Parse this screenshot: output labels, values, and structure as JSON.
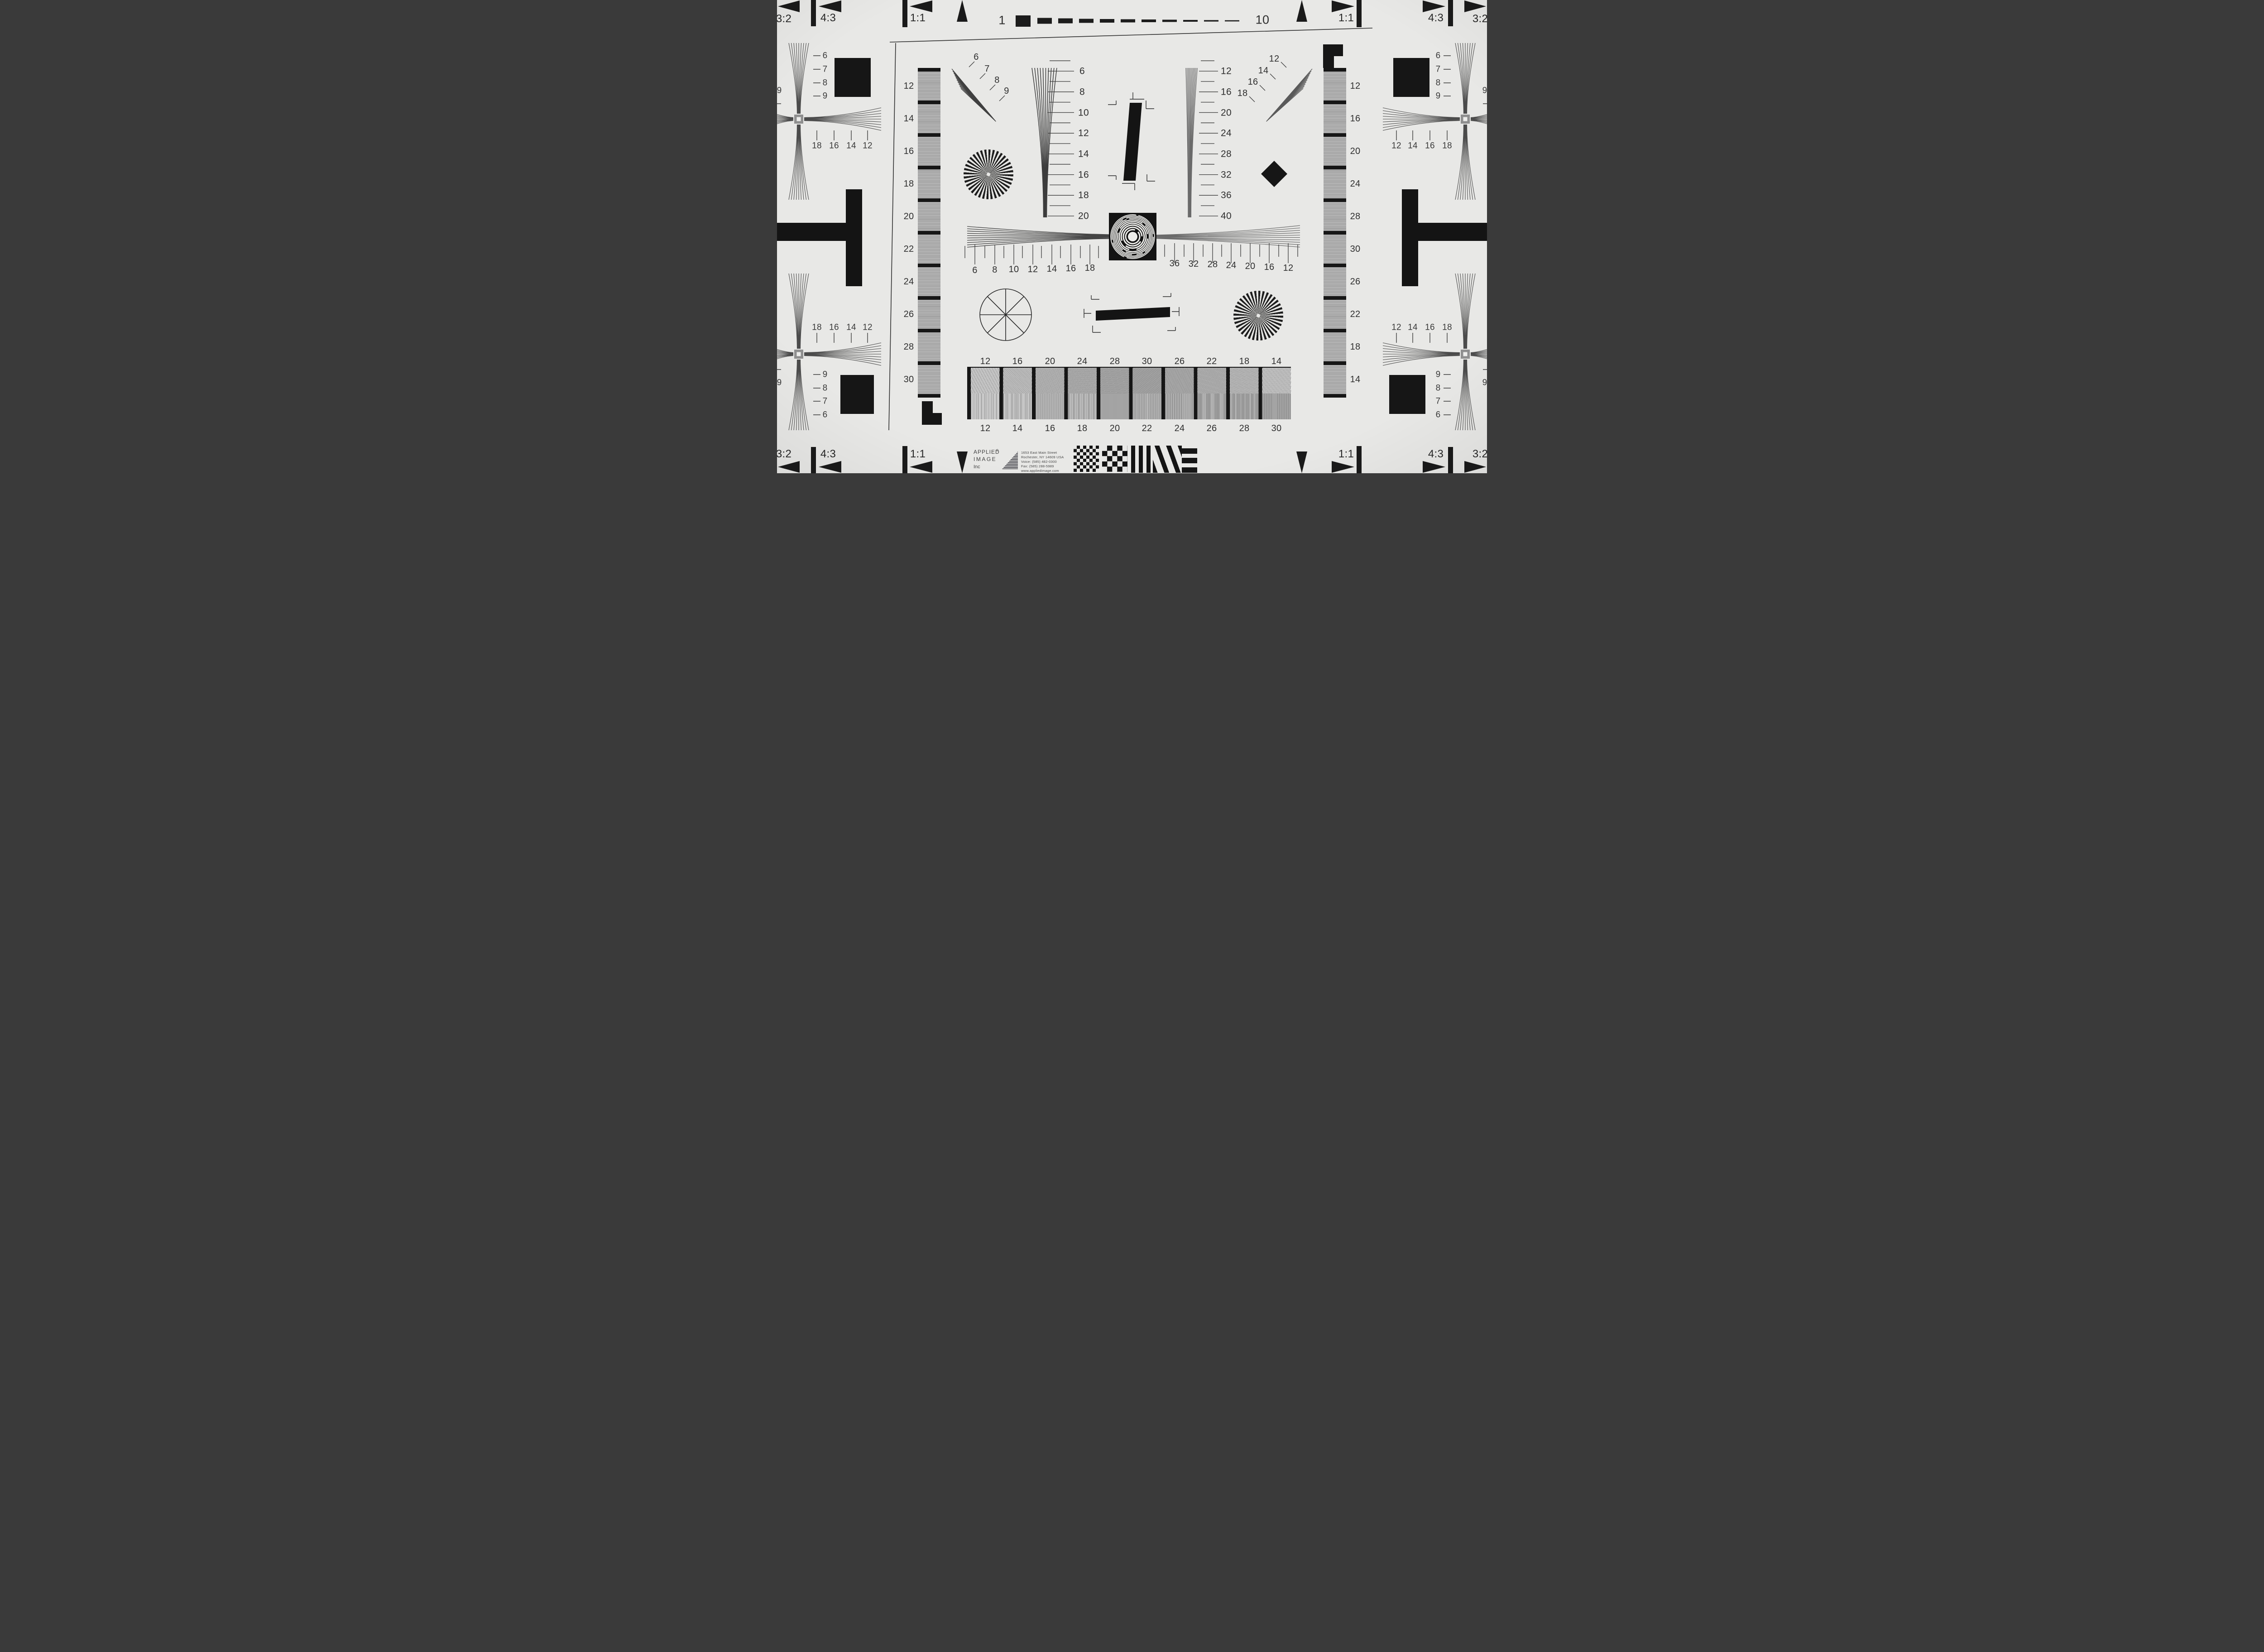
{
  "title": "ISO 12233 resolution test chart",
  "colors": {
    "paper": "#e8e8e6",
    "ink": "#1a1a1a",
    "gray_band": "#a9a9a9"
  },
  "top_ruler": {
    "start": "1",
    "end": "10"
  },
  "aspect": {
    "r32": "3:2",
    "r43": "4:3",
    "r11": "1:1"
  },
  "corner": {
    "diag": [
      "6",
      "7",
      "8",
      "9"
    ],
    "diag_rev": [
      "9",
      "8",
      "7",
      "6"
    ],
    "desc": [
      "18",
      "16",
      "14",
      "12"
    ],
    "asc": [
      "12",
      "14",
      "16",
      "18"
    ],
    "edge": "9"
  },
  "left_strip": {
    "labels": [
      "12",
      "14",
      "16",
      "18",
      "20",
      "22",
      "24",
      "26",
      "28",
      "30"
    ]
  },
  "right_strip": {
    "labels": [
      "12",
      "16",
      "20",
      "24",
      "28",
      "30",
      "26",
      "22",
      "18",
      "14"
    ]
  },
  "v_wedge_left": {
    "labels": [
      "6",
      "8",
      "10",
      "12",
      "14",
      "16",
      "18",
      "20"
    ]
  },
  "v_wedge_right": {
    "labels": [
      "12",
      "16",
      "20",
      "24",
      "28",
      "32",
      "36",
      "40"
    ]
  },
  "tilt_wedge_left": {
    "labels": [
      "6",
      "7",
      "8",
      "9"
    ]
  },
  "tilt_wedge_right": {
    "labels": [
      "12",
      "14",
      "16",
      "18"
    ]
  },
  "h_wedge_left": {
    "labels": [
      "6",
      "8",
      "10",
      "12",
      "14",
      "16",
      "18"
    ]
  },
  "h_wedge_right": {
    "labels": [
      "36",
      "32",
      "28",
      "24",
      "20",
      "16",
      "12"
    ]
  },
  "bottom_bar": {
    "top_labels": [
      "12",
      "16",
      "20",
      "24",
      "28",
      "30",
      "26",
      "22",
      "18",
      "14"
    ],
    "bottom_labels": [
      "12",
      "14",
      "16",
      "18",
      "20",
      "22",
      "24",
      "26",
      "28",
      "30"
    ]
  },
  "logo": {
    "line1": "APPLIED",
    "reg": "®",
    "line2": "IMAGE",
    "line3": "Inc",
    "address": [
      "1653 East Main Street",
      "Rochester, NY  14609  USA",
      "Voice:   (585) 482-0300",
      "Fax:      (585) 288-5989",
      "www.appliedimage.com"
    ]
  }
}
